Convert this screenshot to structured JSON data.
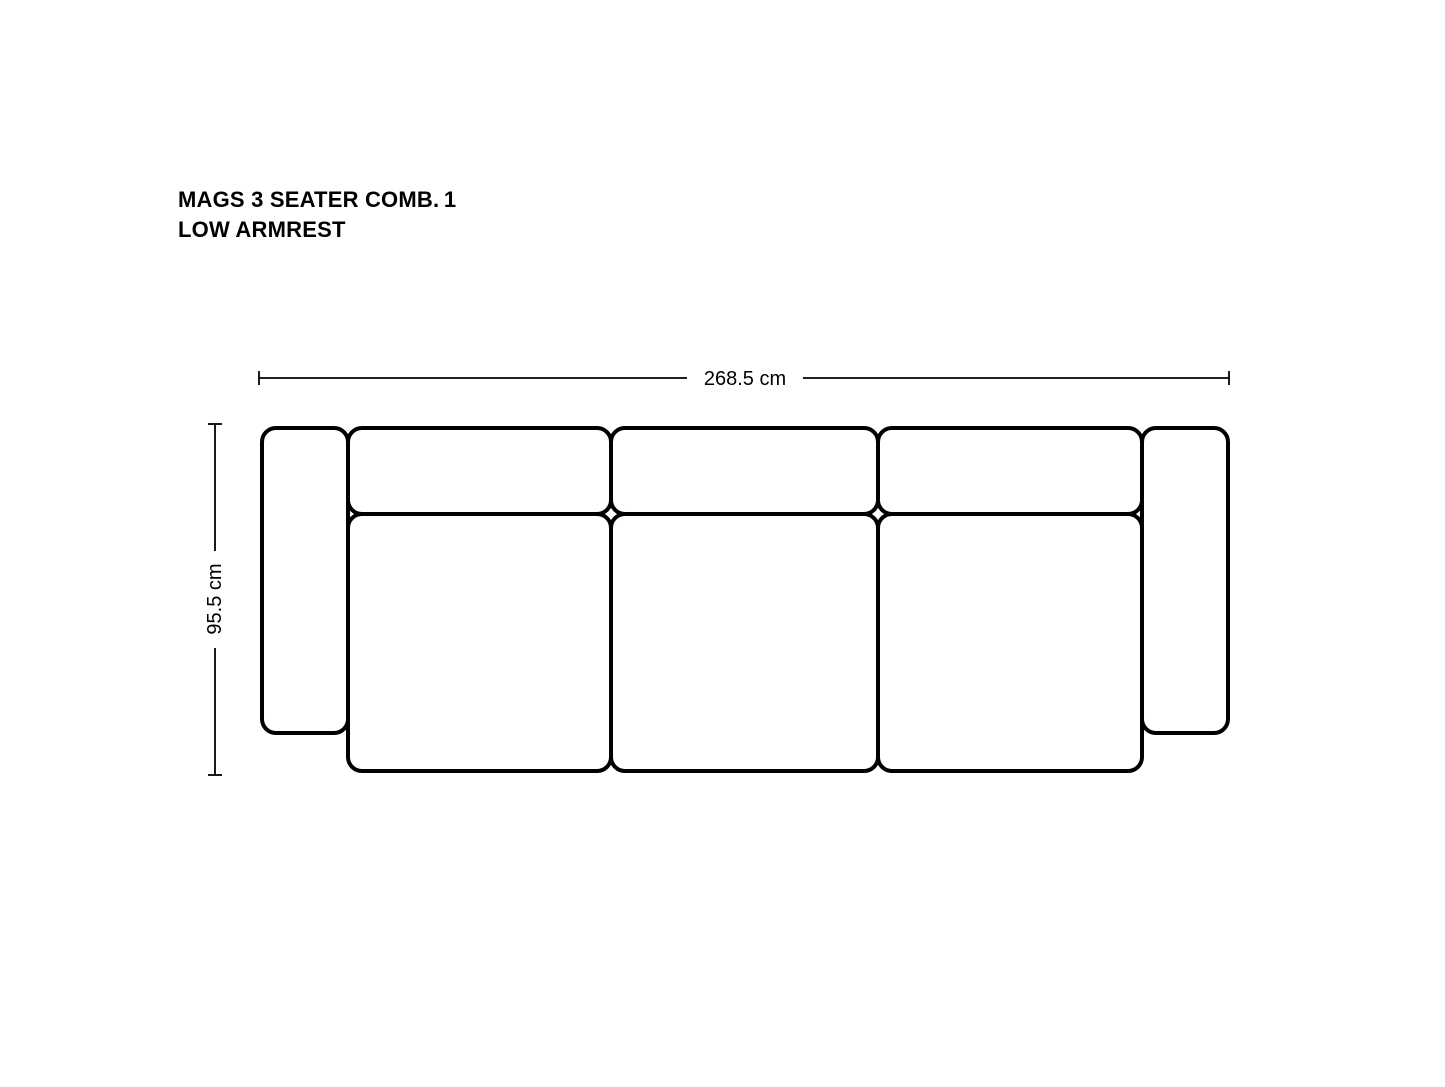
{
  "page": {
    "background_color": "#ffffff",
    "line_color": "#000000"
  },
  "title": {
    "line1": "MAGS 3 SEATER COMB. 1",
    "line2": "LOW ARMREST"
  },
  "diagram": {
    "view": "top-view technical drawing of sofa",
    "width_dimension": {
      "label": "268.5 cm"
    },
    "depth_dimension": {
      "label": "95.5 cm"
    },
    "parts": [
      "left-armrest",
      "backrest-module-1",
      "backrest-module-2",
      "backrest-module-3",
      "seat-cushion-1",
      "seat-cushion-2",
      "seat-cushion-3",
      "right-armrest"
    ]
  }
}
